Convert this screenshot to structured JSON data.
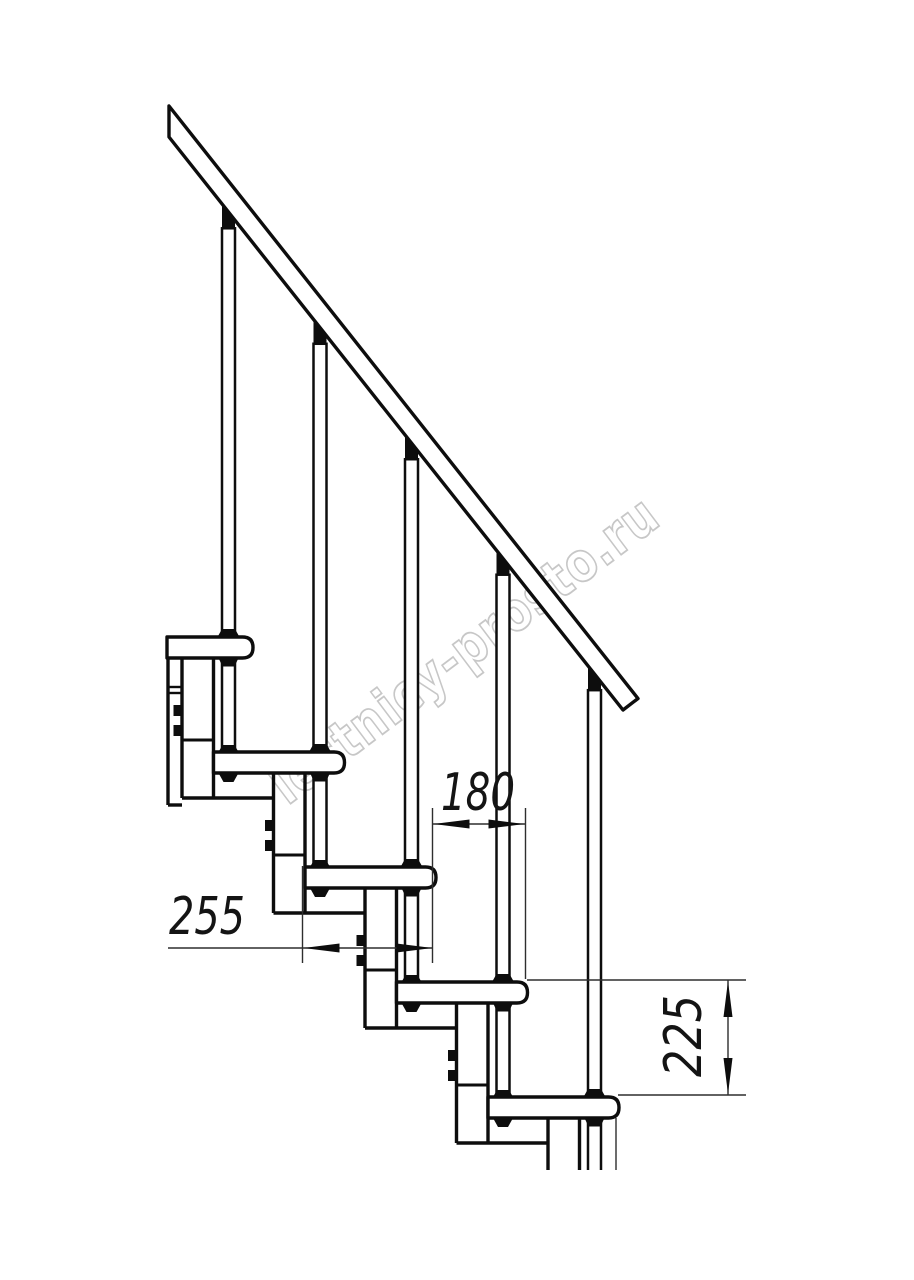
{
  "watermark": {
    "text": "lestnicy-prosto.ru",
    "color": "#c7c7c7"
  },
  "dimensions": {
    "step_run": {
      "label": "180"
    },
    "tread_depth": {
      "label": "255"
    },
    "step_rise": {
      "label": "225"
    }
  },
  "drawing_colors": {
    "line": "#0d0d0d",
    "dim": "#2e2e2e"
  },
  "drawing_meta": {
    "type": "staircase-side-elevation",
    "treads_visible": 5,
    "balusters_visible": 5,
    "has_handrail": true
  }
}
